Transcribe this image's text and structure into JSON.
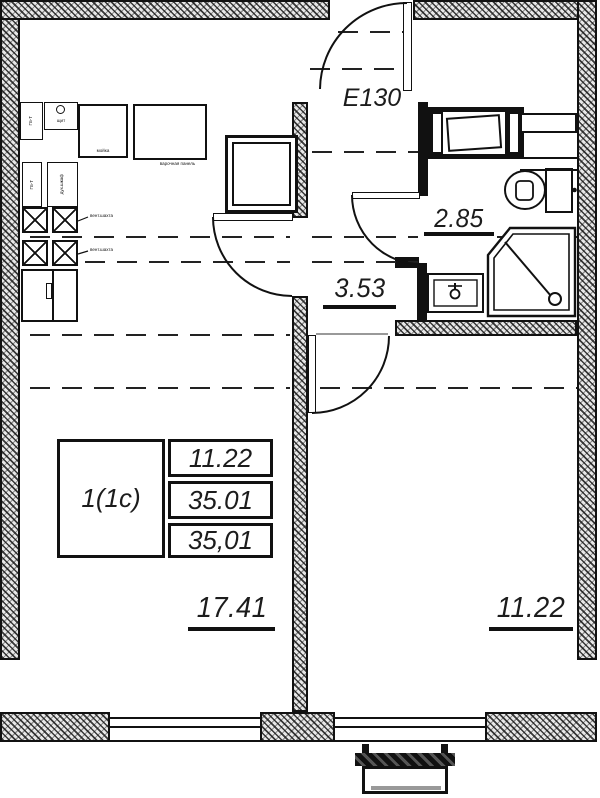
{
  "entry": {
    "door_label": "Е130"
  },
  "rooms": {
    "living": {
      "area": "17.41"
    },
    "bedroom": {
      "area": "11.22"
    },
    "hall": {
      "area": "3.53"
    },
    "bathroom": {
      "area": "2.85"
    }
  },
  "stamp": {
    "unit_type": "1(1с)",
    "living_area": "11.22",
    "total_area": "35.01",
    "total_area_full": "35,01"
  },
  "annotations": {
    "vent_label_1": "вент.шахта",
    "vent_label_2": "вент.шахта",
    "sink_label": "мойка",
    "hob_label": "варочная панель",
    "panel_label": "щит",
    "appliance_label_1": "Пз-Т",
    "appliance_label_2": "дух.шкаф"
  },
  "colors": {
    "line": "#111111",
    "paper": "#ffffff"
  }
}
